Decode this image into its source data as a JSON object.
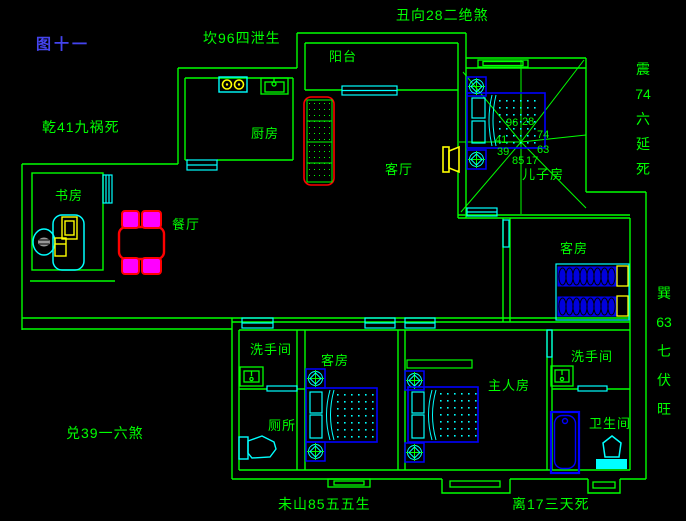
{
  "figure": {
    "title": "图十一"
  },
  "annotations": {
    "kan": "坎96四泄生",
    "chou": "丑向28二绝煞",
    "qian": "乾41九祸死",
    "dui": "兑39一六煞",
    "wei": "未山85五五生",
    "li": "离17三天死",
    "zhen": "震\n74\n六\n延\n死",
    "xun": "巽\n63\n七\n伏\n旺"
  },
  "rooms": {
    "study": "书房",
    "dining": "餐厅",
    "kitchen": "厨房",
    "balcony": "阳台",
    "living": "客厅",
    "sons_room": "儿子房",
    "guest_room_right": "客房",
    "guest_room_bottom": "客房",
    "washroom_left": "洗手间",
    "washroom_right": "洗手间",
    "toilet": "厕所",
    "master_room": "主人房",
    "bathroom": "卫生间"
  },
  "compass": {
    "n_left": "96",
    "n_right": "28",
    "w": "41",
    "e": "74",
    "sw": "39",
    "se": "63",
    "s_left": "85",
    "s_right": "17"
  },
  "colors": {
    "wall": "#00ff00",
    "window": "#00ffff",
    "bed": "#0000ff",
    "door": "#ffff00",
    "sofa_table": "#ff0000",
    "chair_fill": "#ff00ff",
    "title_text": "#4444ee",
    "background": "#000000"
  }
}
